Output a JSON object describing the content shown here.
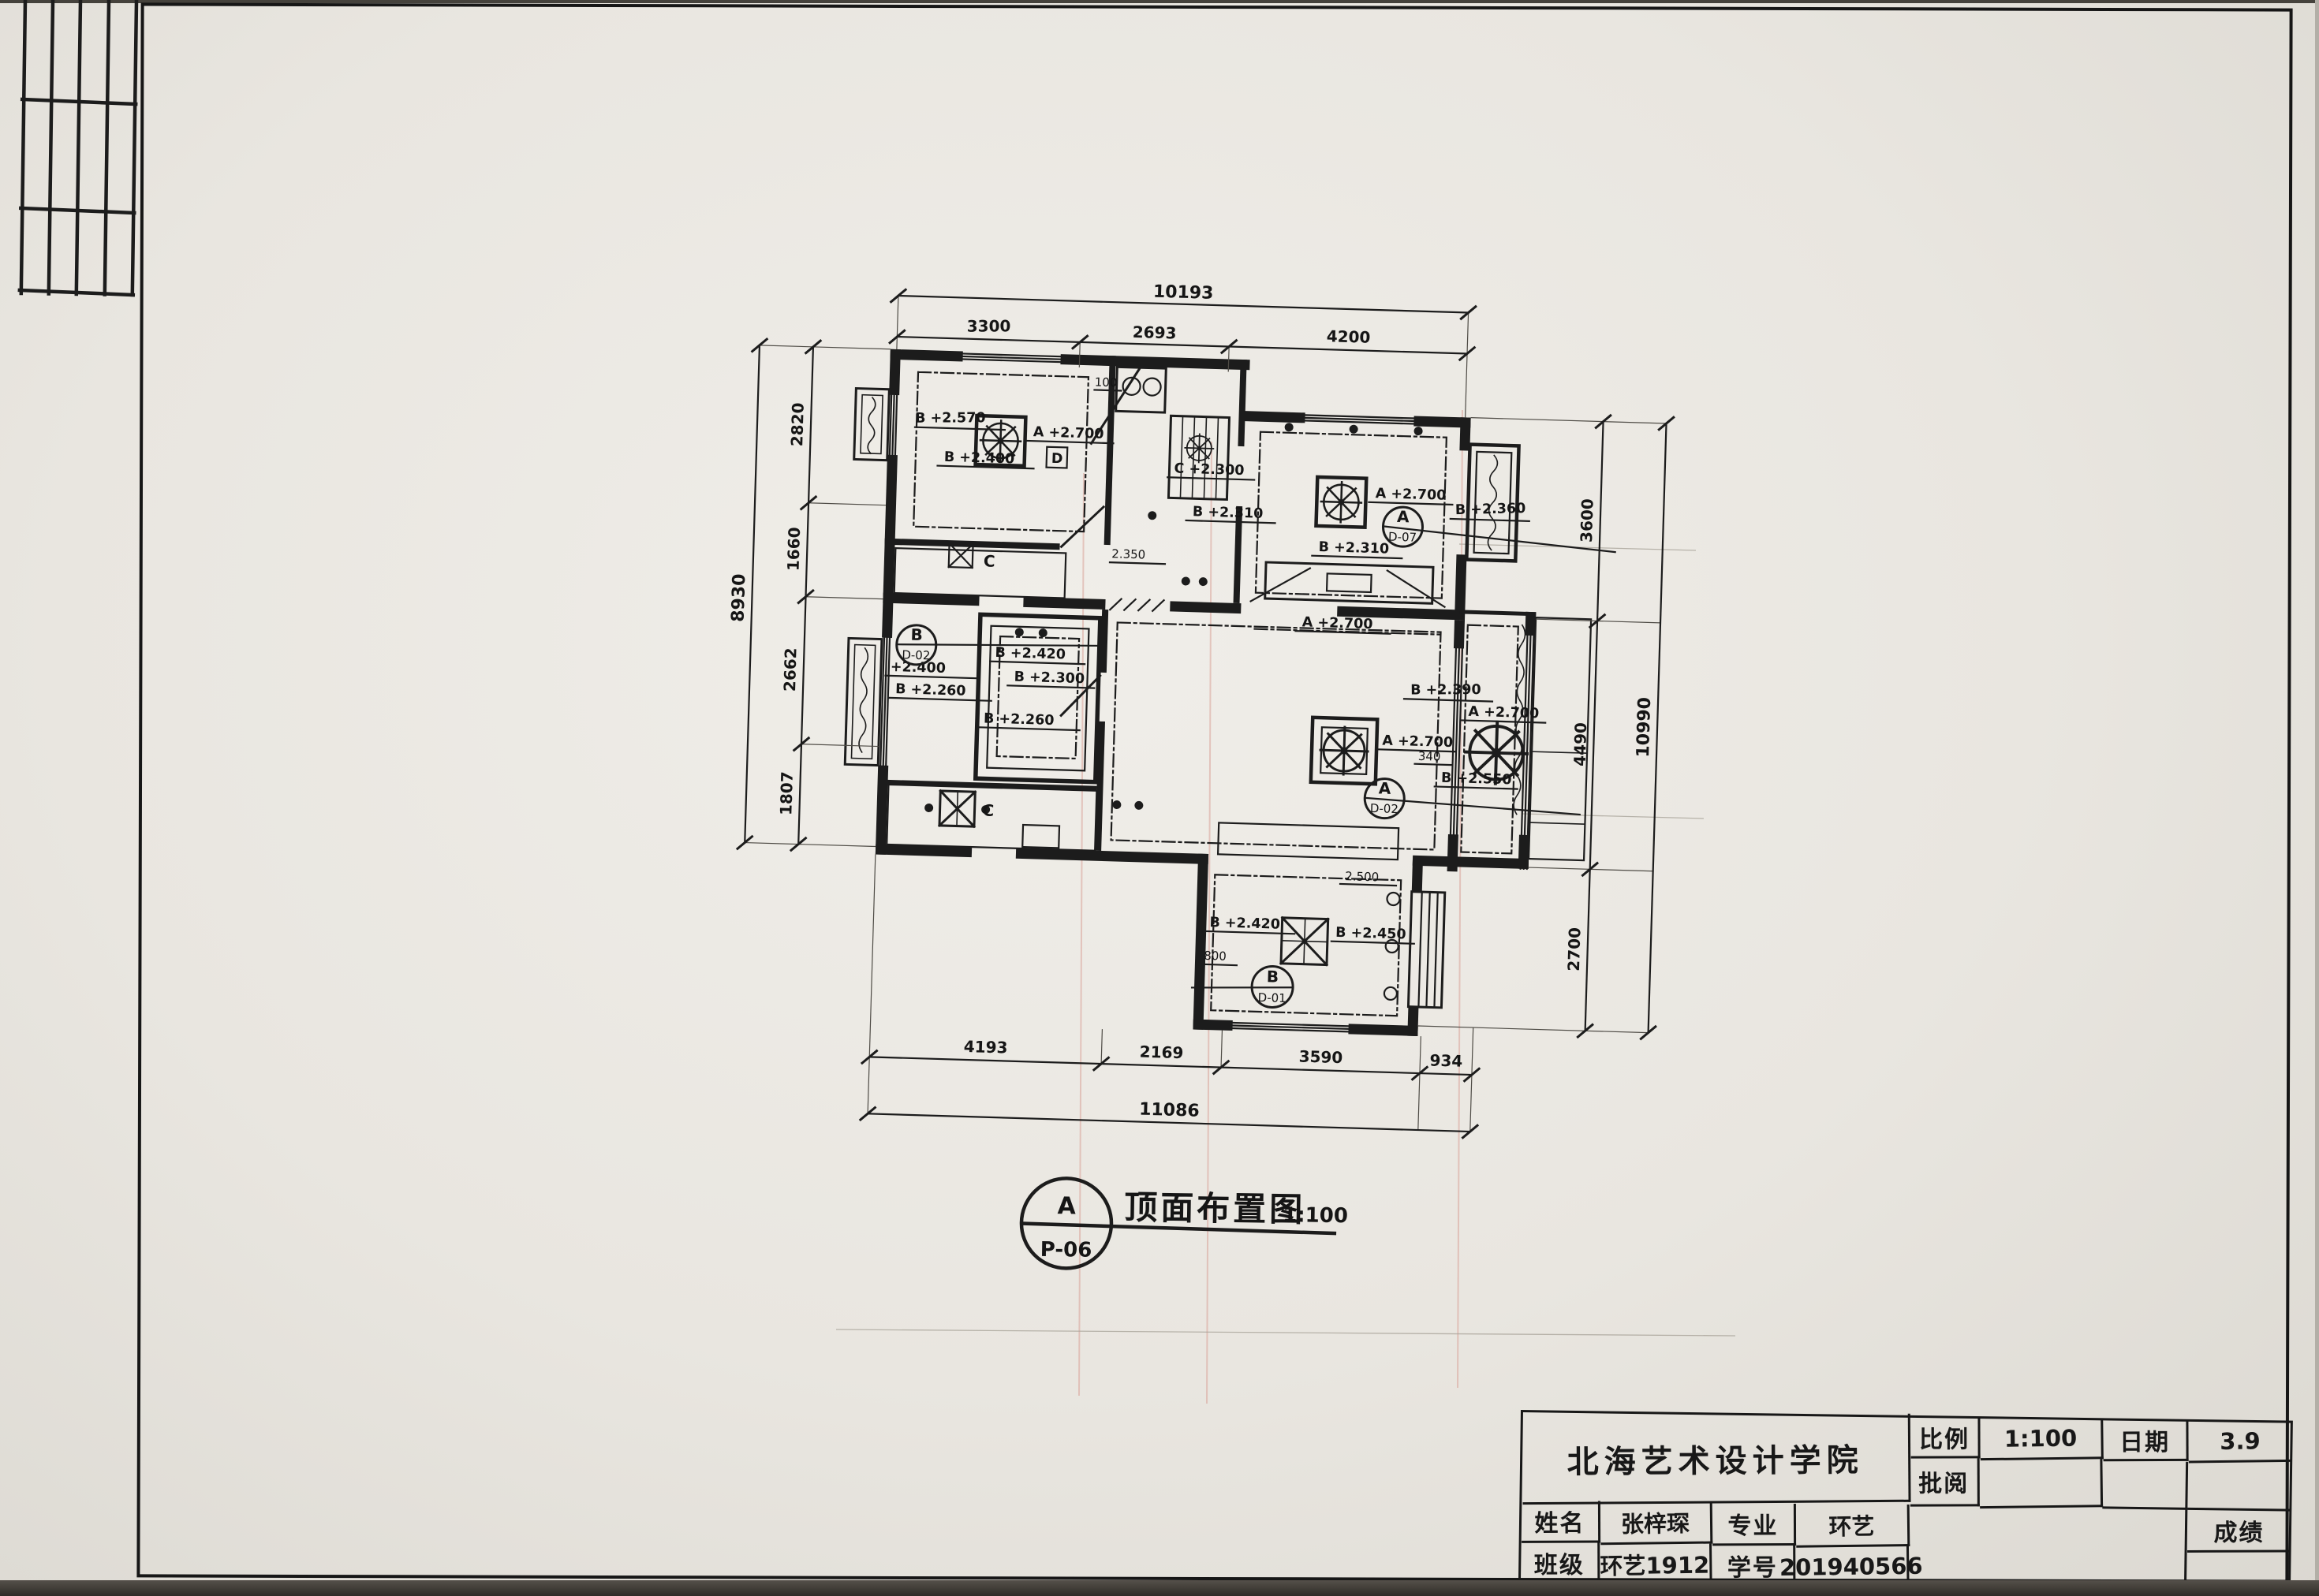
{
  "colors": {
    "paper": "#eae7e1",
    "ink": "#1c1c1c",
    "grid_red": "#d89c92"
  },
  "title_block": {
    "school": "北海艺术设计学院",
    "scale_label": "比例",
    "scale_value": "1:100",
    "date_label": "日期",
    "date_value": "3.9",
    "review_label": "批阅",
    "review_value": "",
    "name_label": "姓名",
    "name_value": "张梓琛",
    "major_label": "专业",
    "major_value": "环艺",
    "class_label": "班级",
    "class_value": "环艺1912",
    "id_label": "学号",
    "id_value": "201940566",
    "grade_label": "成绩",
    "grade_value": ""
  },
  "drawing_label": {
    "detail_letter": "A",
    "detail_number": "P-06",
    "title": "顶面布置图",
    "scale": "1:100"
  },
  "dimensions": {
    "top": {
      "overall": "10193",
      "segments": [
        "3300",
        "2693",
        "4200"
      ]
    },
    "left": {
      "overall": "8930",
      "segments": [
        "2820",
        "1660",
        "2662",
        "1807"
      ]
    },
    "right": {
      "overall": "10990",
      "segments": [
        "3600",
        "4490",
        "2700"
      ]
    },
    "bottom": {
      "overall": "11086",
      "segments": [
        "4193",
        "2169",
        "3590",
        "934"
      ]
    }
  },
  "annotations": [
    "B +2.570",
    "A +2.700",
    "B +2.400",
    "100",
    "C +2.300",
    "B +2.310",
    "A +2.700",
    "B +2.360",
    "B +2.310",
    "A +2.700",
    "2.350",
    "+2.400",
    "B +2.260",
    "B +2.420",
    "B +2.300",
    "B +2.260",
    "B +2.390",
    "A +2.700",
    "340",
    "B +2.550",
    "A +2.700",
    "2.500",
    "B +2.420",
    "B +2.450",
    "800",
    "C",
    "C",
    "D"
  ],
  "detail_refs": [
    {
      "letter": "A",
      "sheet": "D-07"
    },
    {
      "letter": "B",
      "sheet": "D-02"
    },
    {
      "letter": "A",
      "sheet": "D-02"
    },
    {
      "letter": "B",
      "sheet": "D-01"
    }
  ]
}
